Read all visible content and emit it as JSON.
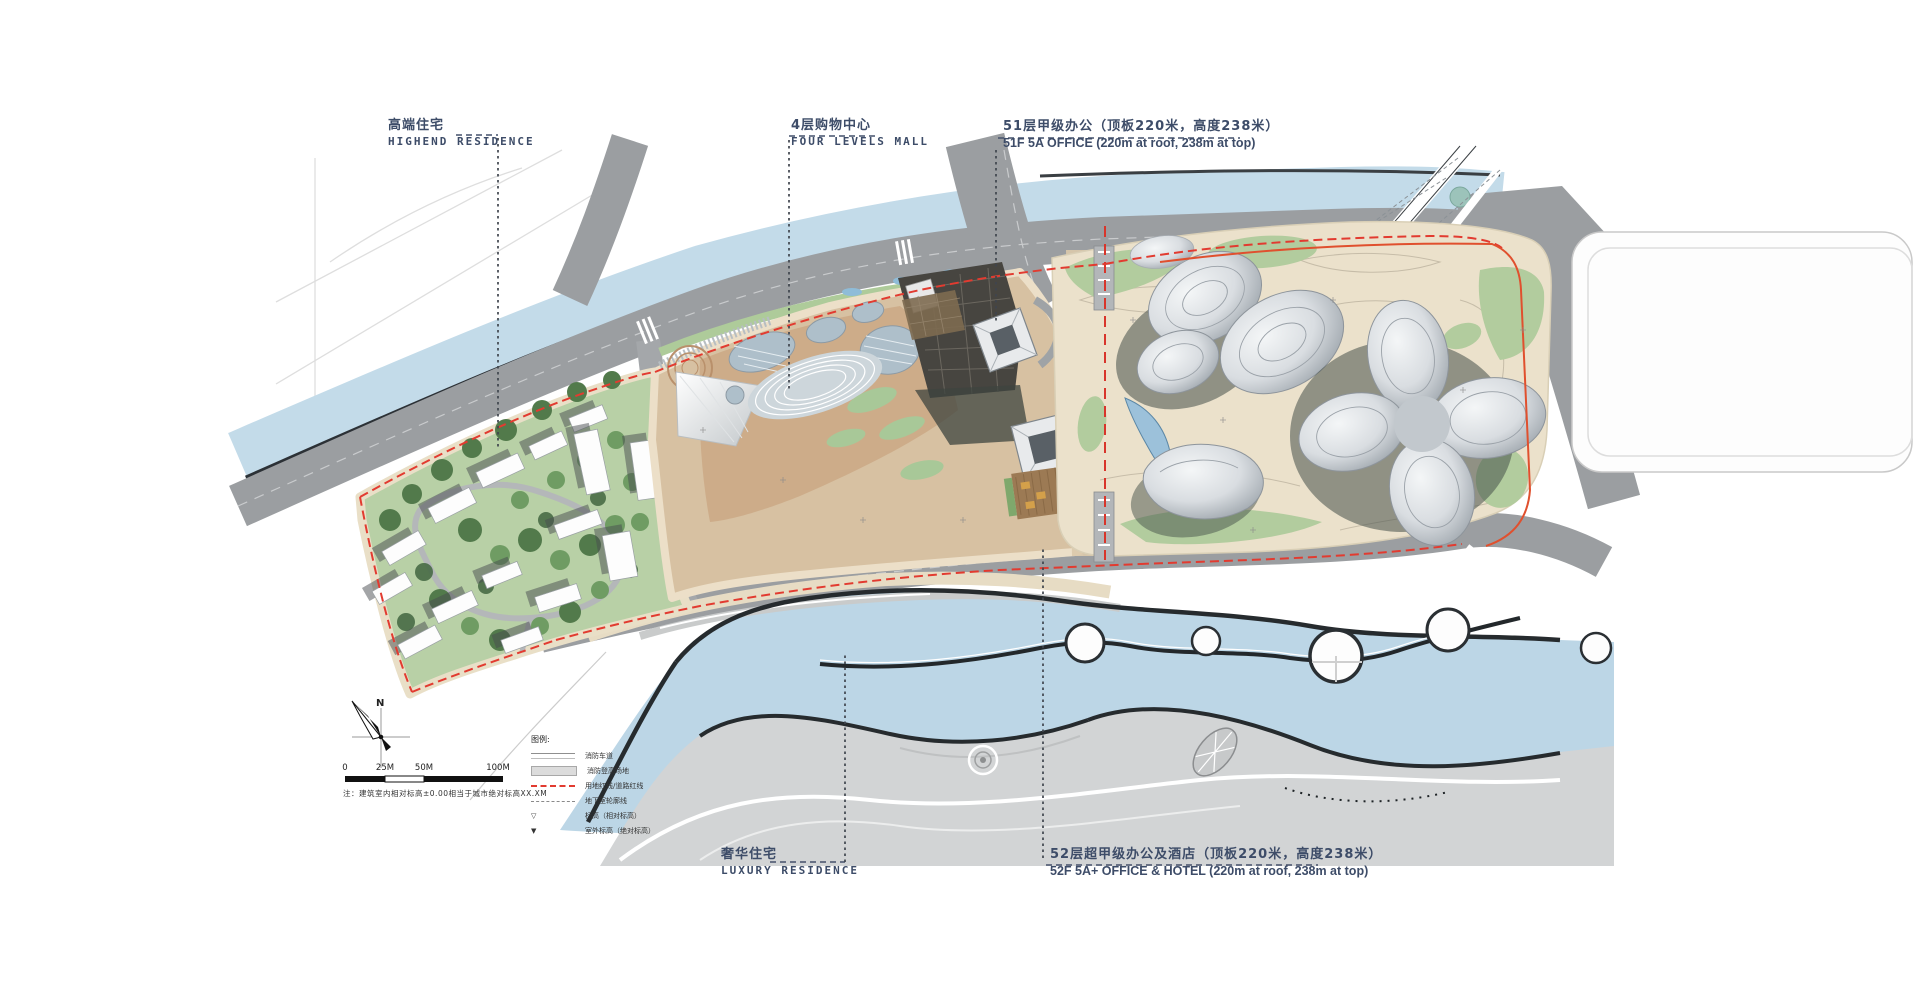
{
  "title_labels": {
    "highend_residence": {
      "zh": "高端住宅",
      "en": "HIGHEND RESIDENCE"
    },
    "four_levels_mall": {
      "zh": "4层购物中心",
      "en": "FOUR LEVELS MALL"
    },
    "office_51f": {
      "zh": "51层甲级办公（顶板220米，高度238米）",
      "en": "51F 5A OFFICE (220m at roof, 238m at top)"
    },
    "luxury_residence": {
      "zh": "奢华住宅",
      "en": "LUXURY RESIDENCE"
    },
    "office_52f": {
      "zh": "52层超甲级办公及酒店（顶板220米，高度238米）",
      "en": "52F 5A+ OFFICE & HOTEL (220m at roof, 238m at top)"
    }
  },
  "legend": {
    "title": "图例:",
    "items": [
      {
        "symbol": "fire-lane-line",
        "label": "消防车道"
      },
      {
        "symbol": "fire-area-box",
        "label": "消防登高场地"
      },
      {
        "symbol": "red-dashed-line",
        "label": "用地红线/道路红线"
      },
      {
        "symbol": "gray-dashed-line",
        "label": "地下室轮廓线"
      },
      {
        "symbol": "level-marker-rel",
        "label": "标高（相对标高）"
      },
      {
        "symbol": "level-marker-abs",
        "label": "室外标高（绝对标高）"
      }
    ]
  },
  "compass": {
    "north_label": "N"
  },
  "scale_bar": {
    "ticks": [
      "0",
      "25M",
      "50M",
      "100M"
    ]
  },
  "note": "注：建筑室内相对标高±0.00相当于城市绝对标高XX.XM",
  "colors": {
    "boundary_red": "#e23b30",
    "river_blue": "#c3dbe9",
    "road_gray": "#9b9ea1",
    "label_blue": "#3d4c68",
    "park_cream": "#ece2cc",
    "lawn_green": "#b5cea3",
    "building_silver": "#d9dde1"
  }
}
